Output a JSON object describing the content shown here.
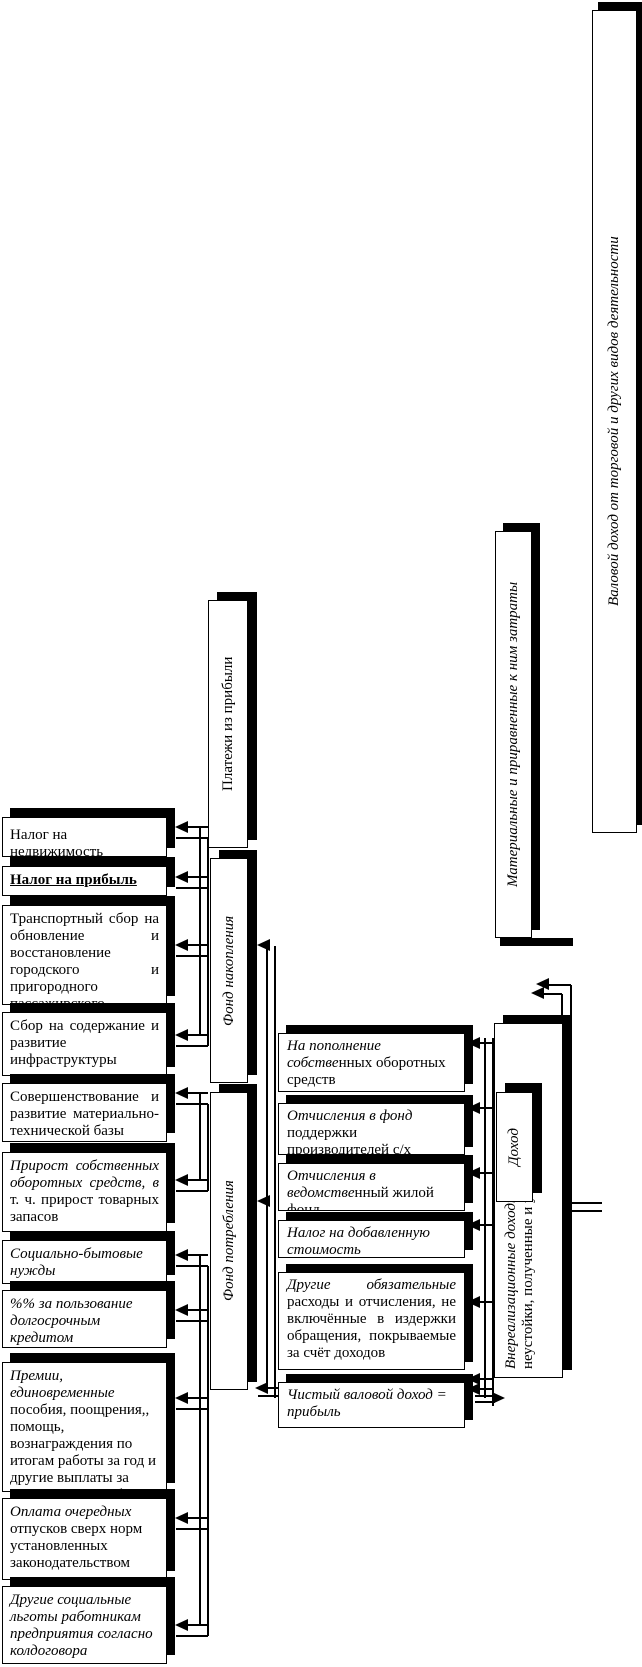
{
  "left_boxes": [
    {
      "name": "nalog-na-nedvizhimost",
      "i": "",
      "r": "Налог на недвижимость"
    },
    {
      "name": "nalog-na-pribyl",
      "i": "",
      "r": "Налог на прибыль"
    },
    {
      "name": "transportny-sbor",
      "i": "",
      "r": "Транспортный сбор на обновление и восстановление городского и пригородного пассажирского"
    },
    {
      "name": "sbor-na-soderzhanie",
      "i": "",
      "r": "Сбор на содержание и развитие инфраструктуры города"
    },
    {
      "name": "sovershenstvovanie-bazy",
      "i": "",
      "r": "Совершенствование и развитие материально-технической базы"
    },
    {
      "name": "prirost-sredstv",
      "i": "Прирост собственных оборотных средств, в ",
      "r": "т. ч. прирост товарных запасов"
    },
    {
      "name": "soc-bytovye-nuzhdy",
      "i": "Социально-бытовые нужды",
      "r": ""
    },
    {
      "name": "procent-za-kredit",
      "i": "%% за пользование долгосрочным кредитом",
      "r": ""
    },
    {
      "name": "premii-posobiya",
      "i": "Премии, единовременные ",
      "r": "пособия, поощрения,, помощь, вознаграждения по итогам работы за год и другие выплаты за достижения в работе"
    },
    {
      "name": "oplata-otpuskov",
      "i": "Оплата очередных ",
      "r": "отпусков сверх норм установленных законодательством"
    },
    {
      "name": "drugie-lgoty",
      "i": "Другие социальные льготы работникам предприятия согласно колдоговора",
      "r": ""
    }
  ],
  "fund_boxes": [
    {
      "name": "platezhi-iz-pribyli",
      "i": "",
      "r": "Платежи из прибыли"
    },
    {
      "name": "fond-nakopleniya",
      "i": "Фонд накопления",
      "r": ""
    },
    {
      "name": "fond-potrebleniya",
      "i": "Фонд потребления",
      "r": ""
    }
  ],
  "middle_boxes": [
    {
      "name": "popolnenie-oborotnyh-sredstv",
      "i": "На пополнение собстве",
      "r": "нных оборотных средств"
    },
    {
      "name": "fond-podderzhki-sh",
      "i": "Отчисления в фонд ",
      "r": "поддержки производителей с/х продукции"
    },
    {
      "name": "vedomstvenny-zhiloy-fond",
      "i": "Отчисления в ведомстве",
      "r": "нный жилой фонд"
    },
    {
      "name": "nds",
      "i": "Налог на добавленную стоимость",
      "r": ""
    },
    {
      "name": "drugie-obyazatelnye-raskhody",
      "i": "Другие обязательные ",
      "r": "расходы и отчисления, не включённые в издержки обращения, покрываемые за счёт доходов"
    },
    {
      "name": "chisty-valovoy-dokhod",
      "i": "Чистый валовой доход = прибыль",
      "r": ""
    }
  ],
  "right_boxes": {
    "dohod": {
      "i": "Доход",
      "r": ""
    },
    "vnerealiz_line1": {
      "i": "Внереализационные доходы, ",
      "r": "штрафы, пени,"
    },
    "vnerealiz_line2": {
      "i": "",
      "r": "неустойки, полученные и упл"
    },
    "material": {
      "i": "Материальные и приравненные к ним затраты",
      "r": ""
    },
    "valovoy": {
      "i": "Валовой доход от торговой и других видов деятельности",
      "r": ""
    }
  }
}
